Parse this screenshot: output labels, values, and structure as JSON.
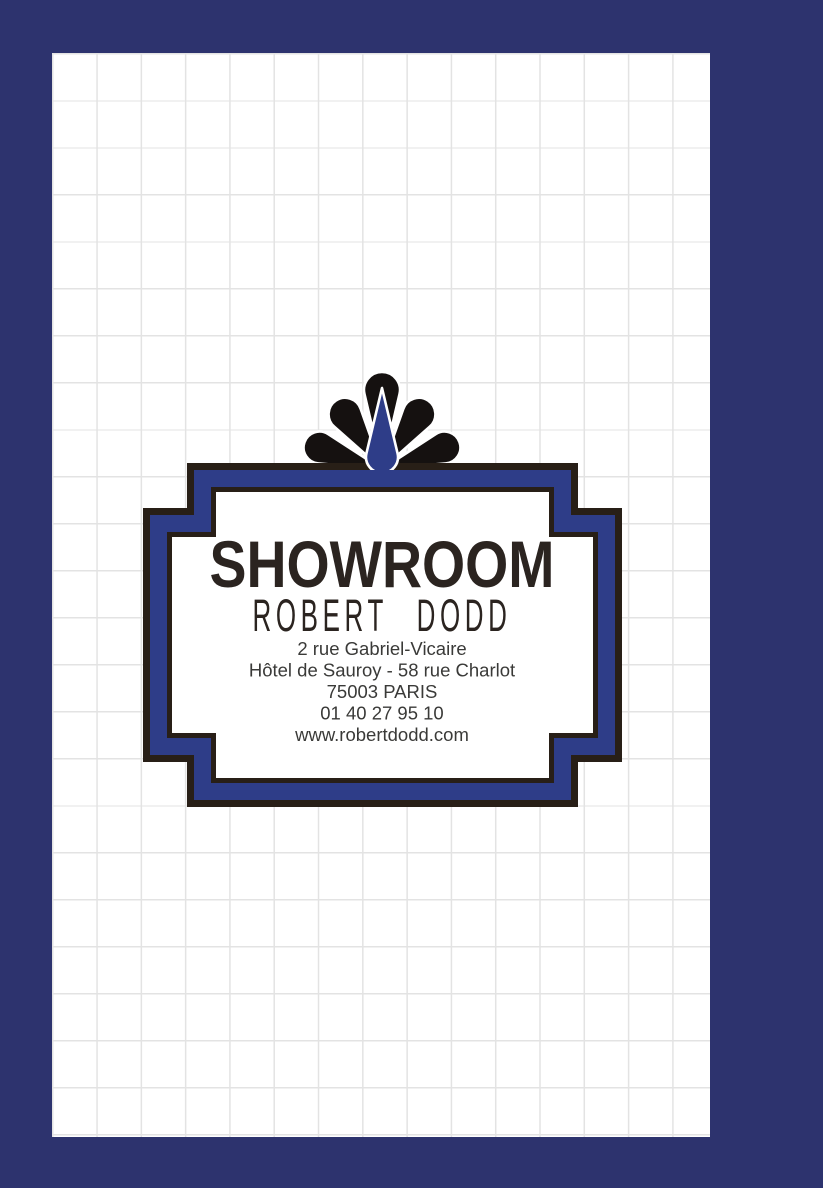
{
  "poster": {
    "title": "SHOWROOM",
    "name": "ROBERT DODD",
    "address_lines": [
      "2 rue Gabriel-Vicaire",
      "Hôtel de Sauroy - 58 rue Charlot",
      "75003 PARIS",
      "01 40 27 95 10",
      "www.robertdodd.com"
    ],
    "colors": {
      "page_border_navy": "#2d336e",
      "badge_blue": "#2e3d88",
      "frame_dark": "#281f17",
      "ornament_black": "#151110",
      "title_dark": "#2b2420",
      "address_gray": "#3a3a38",
      "grid_line": "#e3e3e3",
      "paper_white": "#ffffff"
    },
    "ornament": "peacock-fan"
  }
}
